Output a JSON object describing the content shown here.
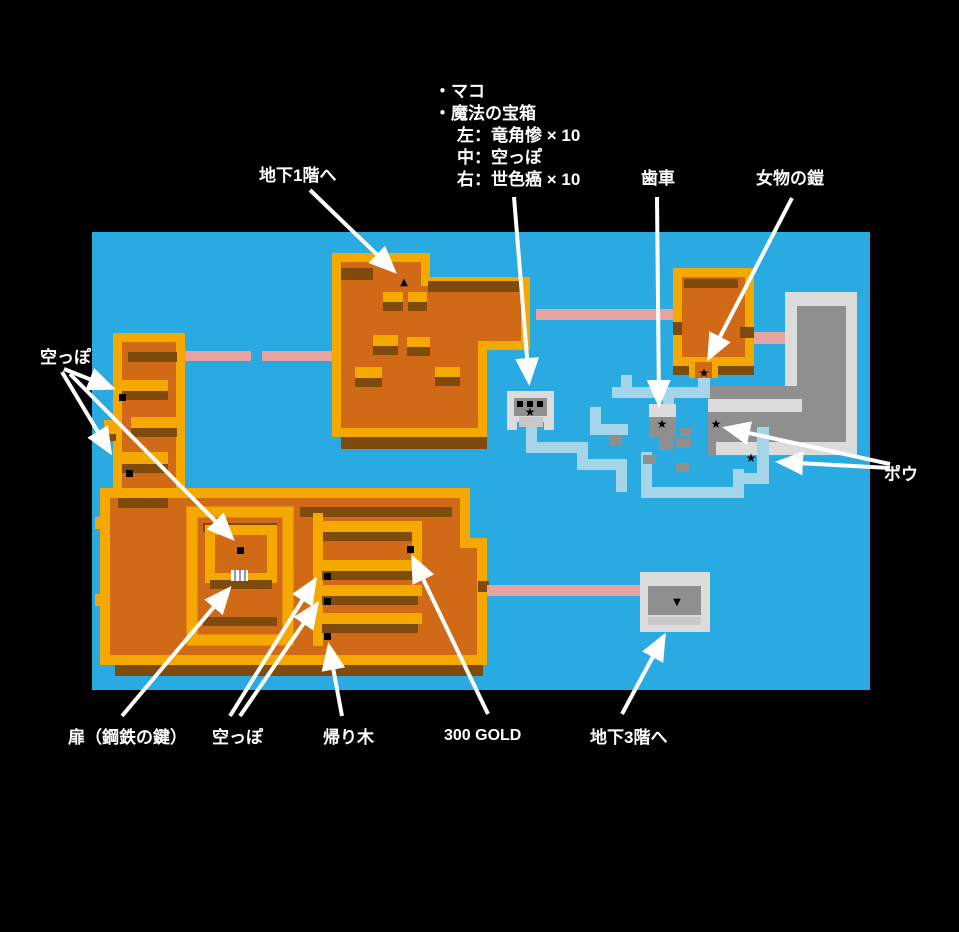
{
  "notes": {
    "line1": "・マコ",
    "line2": "・魔法の宝箱",
    "line3": "左：竜角惨 × 10",
    "line4": "中：空っぽ",
    "line5": "右：世色癌 × 10"
  },
  "labels": {
    "to_b1f": "地下1階へ",
    "gear": "歯車",
    "womens_armor": "女物の鎧",
    "empty_left": "空っぽ",
    "pou": "ポウ",
    "door_steel_key": "扉（鋼鉄の鍵）",
    "empty_bottom": "空っぽ",
    "return_tree": "帰り木",
    "gold300": "300 GOLD",
    "to_b3f": "地下3階へ"
  },
  "markers": {
    "star": "★",
    "stairs_up": "▲",
    "stairs_down": "▼"
  },
  "colors": {
    "background": "#000000",
    "map_water": "#29ABE2",
    "room_fill": "#D06A16",
    "wall_gold": "#F5A800",
    "shadow_brown": "#7E4B0C",
    "corridor_pink": "#E8A2A2",
    "maze_path": "#A5D5E8",
    "gray_bright": "#DCDCDC",
    "gray_mid": "#8F8F8F",
    "marker_black": "#000000",
    "label_white": "#FFFFFF"
  }
}
